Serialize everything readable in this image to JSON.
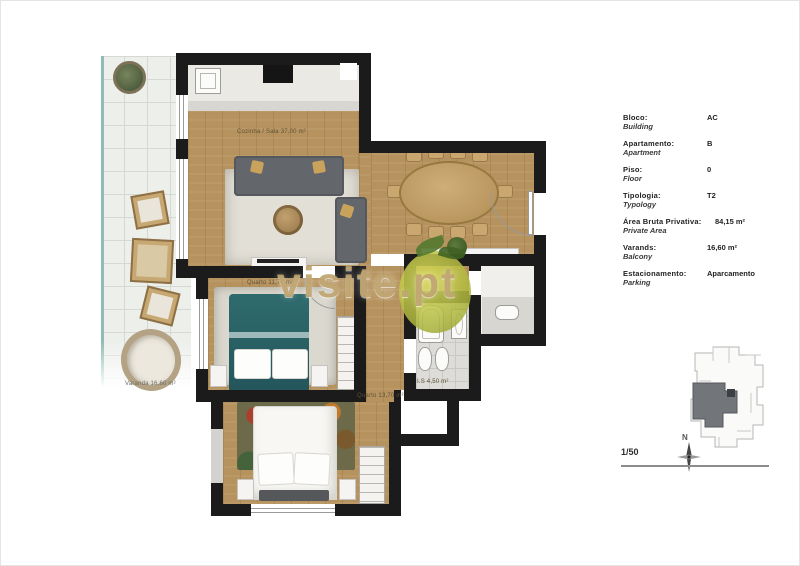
{
  "watermark": {
    "text": "visite.pt"
  },
  "plan": {
    "labels": {
      "living": "Cozinha / Sala 37,00 m²",
      "bedroom1": "Quarto 11,70 m²",
      "bedroom2": "Quarto 13,70 m²",
      "bathroom": "I.S 4,50 m²",
      "balcony": "Varanda 16,60 m²"
    }
  },
  "info_panel": {
    "rows": [
      {
        "label": "Bloco:",
        "sublabel": "Building",
        "value": "AC"
      },
      {
        "label": "Apartamento:",
        "sublabel": "Apartment",
        "value": "B"
      },
      {
        "label": "Piso:",
        "sublabel": "Floor",
        "value": "0"
      },
      {
        "label": "Tipologia:",
        "sublabel": "Typology",
        "value": "T2"
      },
      {
        "label": "Área Bruta Privativa:",
        "sublabel": "Private Area",
        "value": "84,15 m²"
      },
      {
        "label": "Varands:",
        "sublabel": "Balcony",
        "value": "16,60 m²"
      },
      {
        "label": "Estacionamento:",
        "sublabel": "Parking",
        "value": "Aparcamento"
      }
    ]
  },
  "legend": {
    "scale": "1/50",
    "north_label": "N"
  },
  "colors": {
    "wall": "#1b1b1b",
    "wood": "#b6935e",
    "teal_bed": "#2a6065",
    "watermark": "#bc9f68",
    "balcony_edge": "#8fbcb4",
    "unit_highlight": "#72757a"
  }
}
